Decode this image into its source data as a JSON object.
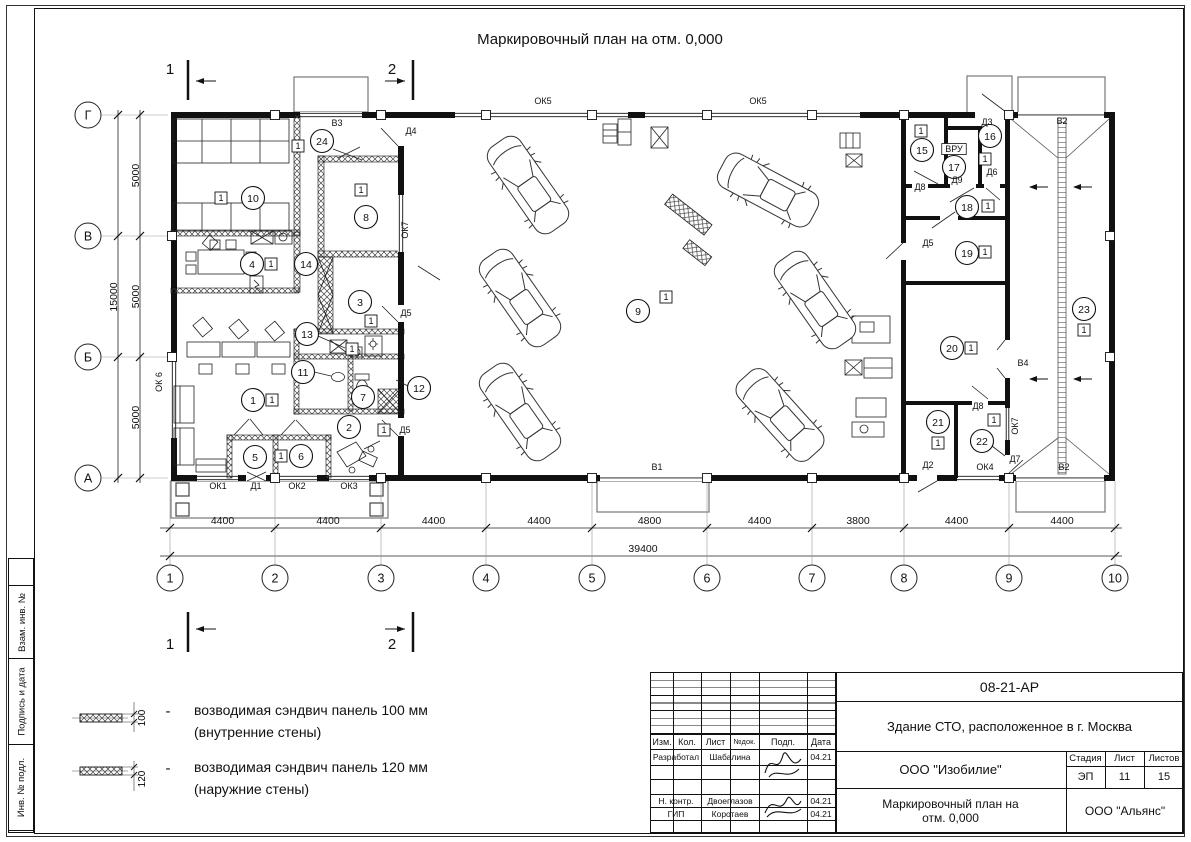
{
  "sheet": {
    "title": "Маркировочный план на отм. 0,000",
    "side_strip": [
      "Взам. инв. №",
      "Подпись и дата",
      "Инв. № подл."
    ]
  },
  "legend": {
    "items": [
      {
        "dim": "100",
        "dash": "-",
        "line1": "возводимая сэндвич панель 100 мм",
        "line2": "(внутренние стены)"
      },
      {
        "dim": "120",
        "dash": "-",
        "line1": "возводимая сэндвич панель 120 мм",
        "line2": "(наружние стены)"
      }
    ]
  },
  "title_block": {
    "doc_number": "08-21-АР",
    "project": "Здание СТО, расположенное в г. Москва",
    "company": "ООО \"Изобилие\"",
    "stage_label": "Стадия",
    "sheet_label": "Лист",
    "sheets_label": "Листов",
    "stage": "ЭП",
    "sheet": "11",
    "sheets": "15",
    "drawing_title_1": "Маркировочный план на",
    "drawing_title_2": "отм. 0,000",
    "contractor": "ООО \"Альянс\"",
    "header_cols": [
      "Изм.",
      "Кол.",
      "Лист",
      "№док.",
      "Подп.",
      "Дата"
    ],
    "rows": [
      {
        "role": "Разработал",
        "name": "Шабалина",
        "date": "04.21"
      },
      {
        "role": "Н. контр.",
        "name": "Двоеглазов",
        "date": "04.21"
      },
      {
        "role": "ГИП",
        "name": "Коротаев",
        "date": "04.21"
      }
    ]
  },
  "plan": {
    "axes_h": [
      "1",
      "2",
      "3",
      "4",
      "5",
      "6",
      "7",
      "8",
      "9",
      "10"
    ],
    "axes_v": [
      "Г",
      "В",
      "Б",
      "А"
    ],
    "dims_h": [
      "4400",
      "4400",
      "4400",
      "4400",
      "4800",
      "4400",
      "3800",
      "4400",
      "4400"
    ],
    "dim_h_total": "39400",
    "dims_v": [
      "5000",
      "5000",
      "5000"
    ],
    "dim_v_total": "15000",
    "section_marks": [
      "1",
      "2"
    ],
    "rooms": [
      {
        "num": "10",
        "x": 253,
        "y": 198,
        "tag": "1",
        "bx": 221,
        "by": 198
      },
      {
        "num": "24",
        "x": 322,
        "y": 141,
        "tag": "1",
        "bx": 298,
        "by": 146
      },
      {
        "num": "8",
        "x": 366,
        "y": 217,
        "tag": "1",
        "bx": 361,
        "by": 190
      },
      {
        "num": "4",
        "x": 252,
        "y": 264,
        "tag": "1",
        "bx": 271,
        "by": 264
      },
      {
        "num": "14",
        "x": 306,
        "y": 264
      },
      {
        "num": "3",
        "x": 360,
        "y": 302,
        "tag": "1",
        "bx": 371,
        "by": 321
      },
      {
        "num": "13",
        "x": 307,
        "y": 334,
        "tag": "1",
        "bx": 352,
        "by": 349
      },
      {
        "num": "11",
        "x": 303,
        "y": 372
      },
      {
        "num": "1",
        "x": 253,
        "y": 400,
        "tag": "1",
        "bx": 272,
        "by": 400
      },
      {
        "num": "7",
        "x": 363,
        "y": 397
      },
      {
        "num": "12",
        "x": 419,
        "y": 388
      },
      {
        "num": "2",
        "x": 349,
        "y": 427,
        "tag": "1",
        "bx": 384,
        "by": 430
      },
      {
        "num": "5",
        "x": 255,
        "y": 457
      },
      {
        "num": "6",
        "x": 301,
        "y": 456,
        "tag": "1",
        "bx": 281,
        "by": 456
      },
      {
        "num": "9",
        "x": 638,
        "y": 311,
        "tag": "1",
        "bx": 666,
        "by": 297
      },
      {
        "num": "15",
        "x": 922,
        "y": 150,
        "tag": "1",
        "bx": 921,
        "by": 131
      },
      {
        "num": "16",
        "x": 990,
        "y": 136,
        "tag": "1",
        "bx": 985,
        "by": 159
      },
      {
        "num": "17",
        "x": 954,
        "y": 167
      },
      {
        "num": "18",
        "x": 967,
        "y": 207,
        "tag": "1",
        "bx": 988,
        "by": 206
      },
      {
        "num": "19",
        "x": 967,
        "y": 253,
        "tag": "1",
        "bx": 985,
        "by": 252
      },
      {
        "num": "20",
        "x": 952,
        "y": 348,
        "tag": "1",
        "bx": 971,
        "by": 348
      },
      {
        "num": "21",
        "x": 938,
        "y": 422,
        "tag": "1",
        "bx": 938,
        "by": 443
      },
      {
        "num": "22",
        "x": 982,
        "y": 441,
        "tag": "1",
        "bx": 994,
        "by": 420
      },
      {
        "num": "23",
        "x": 1084,
        "y": 309,
        "tag": "1",
        "bx": 1084,
        "by": 330
      }
    ],
    "openings": [
      {
        "label": "ОК5",
        "x": 543,
        "y": 104
      },
      {
        "label": "ОК5",
        "x": 758,
        "y": 104
      },
      {
        "label": "В3",
        "x": 337,
        "y": 126
      },
      {
        "label": "Д4",
        "x": 411,
        "y": 134
      },
      {
        "label": "ОК7",
        "x": 408,
        "y": 230,
        "rot": -90
      },
      {
        "label": "Д5",
        "x": 406,
        "y": 316
      },
      {
        "label": "Д5",
        "x": 405,
        "y": 433
      },
      {
        "label": "ОК 6",
        "x": 162,
        "y": 382,
        "rot": -90
      },
      {
        "label": "ОК1",
        "x": 218,
        "y": 489
      },
      {
        "label": "Д1",
        "x": 256,
        "y": 489
      },
      {
        "label": "ОК2",
        "x": 297,
        "y": 489
      },
      {
        "label": "ОК3",
        "x": 349,
        "y": 489
      },
      {
        "label": "В1",
        "x": 657,
        "y": 470
      },
      {
        "label": "Д3",
        "x": 987,
        "y": 125
      },
      {
        "label": "В2",
        "x": 1062,
        "y": 124
      },
      {
        "label": "Д8",
        "x": 920,
        "y": 190
      },
      {
        "label": "ВРУ",
        "x": 954,
        "y": 152,
        "box": true
      },
      {
        "label": "Д9",
        "x": 957,
        "y": 183
      },
      {
        "label": "Д6",
        "x": 992,
        "y": 175
      },
      {
        "label": "Д5",
        "x": 928,
        "y": 246
      },
      {
        "label": "В4",
        "x": 1023,
        "y": 366
      },
      {
        "label": "Д8",
        "x": 978,
        "y": 409
      },
      {
        "label": "ОК7",
        "x": 1018,
        "y": 426,
        "rot": -90
      },
      {
        "label": "Д2",
        "x": 928,
        "y": 468
      },
      {
        "label": "ОК4",
        "x": 985,
        "y": 470
      },
      {
        "label": "Д7",
        "x": 1015,
        "y": 462
      },
      {
        "label": "В2",
        "x": 1064,
        "y": 470
      }
    ]
  }
}
